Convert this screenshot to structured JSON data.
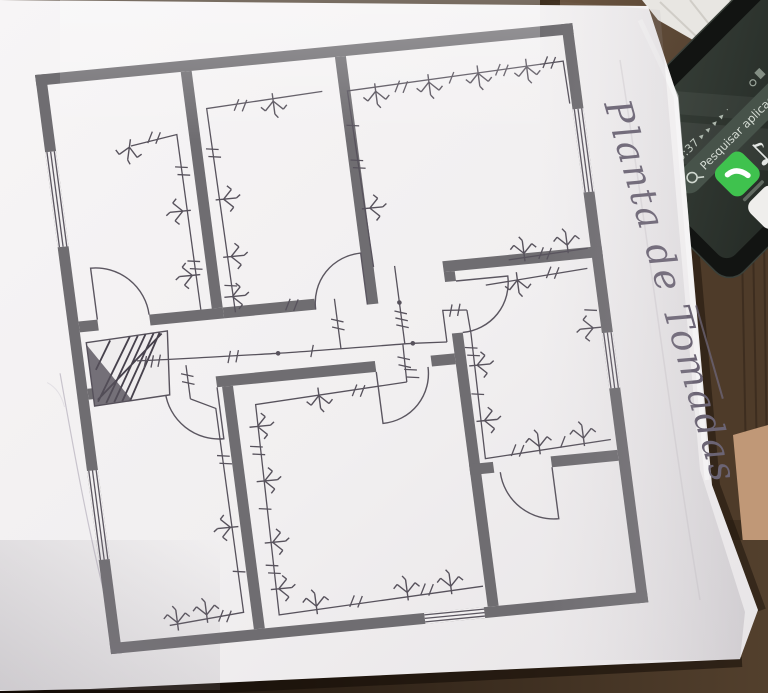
{
  "drawing": {
    "title": "Planta de Tomadas"
  },
  "phone": {
    "time": "15:37",
    "status_icons": "▸ ▸ ▸ ▸ ·",
    "search_placeholder": "Pesquisar aplicações"
  },
  "palette": {
    "paper": "#f2f0f1",
    "wall_gray": "#6f6d71",
    "ink": "#57525c",
    "pencil_text": "#6b6474",
    "wood_dark": "#2a1d12",
    "wood_mid": "#4b3a28",
    "wood_light": "#c09877",
    "phone_screen": "#242a24",
    "accent_green": "#3fc24e",
    "search_pill": "#47534a"
  }
}
